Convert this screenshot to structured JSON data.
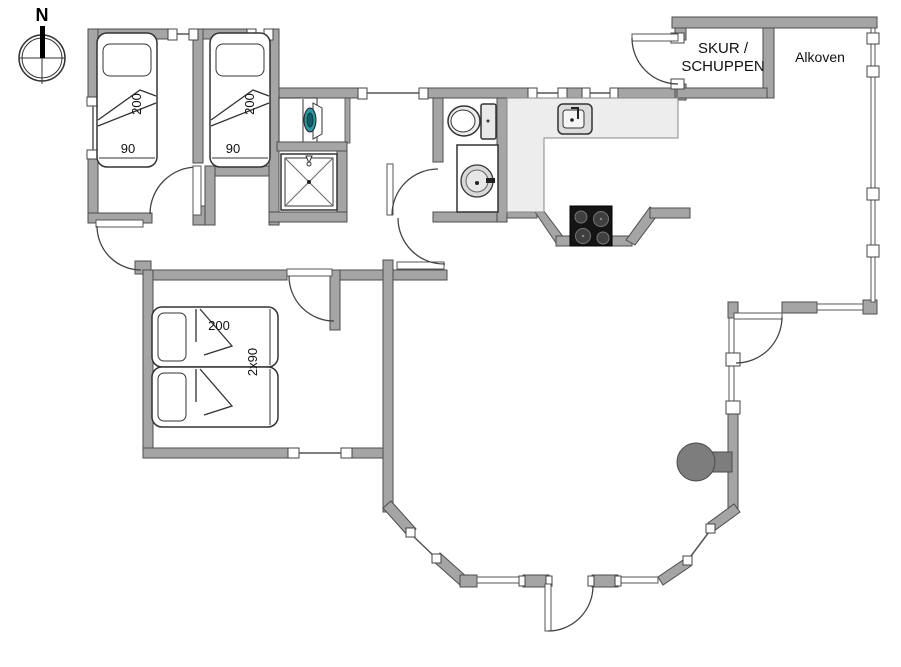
{
  "plan": {
    "compass_label": "N",
    "rooms": {
      "skur_line1": "SKUR /",
      "skur_line2": "SCHUPPEN",
      "alkoven": "Alkoven"
    },
    "beds": {
      "bed1": {
        "length": "200",
        "width": "90"
      },
      "bed2": {
        "length": "200",
        "width": "90"
      },
      "double_bed": {
        "length": "200",
        "width": "2x90"
      }
    }
  },
  "colors": {
    "floor": "#ffffff",
    "wall": "#a5a5a5",
    "wall_outline": "#4d4d4d",
    "counter": "#ededed",
    "stove": "#141414",
    "burner": "#3f3f3f",
    "wood_stove": "#7d7d7d",
    "washer_accent": "#2d96a0",
    "line": "#444444"
  }
}
